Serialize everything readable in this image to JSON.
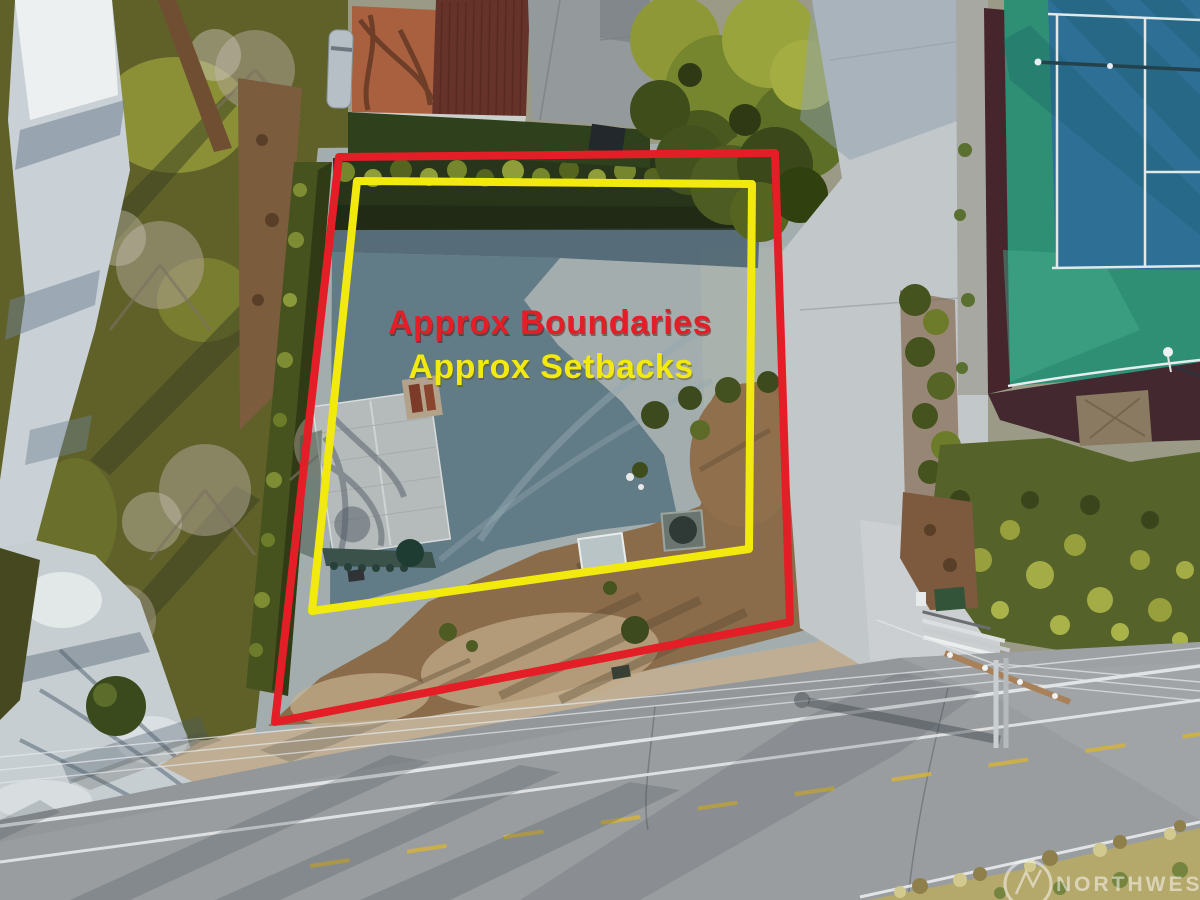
{
  "annotations": {
    "boundaries_label": "Approx Boundaries",
    "setbacks_label": "Approx Setbacks",
    "boundary_color": "#e31e26",
    "setback_color": "#f2e90e"
  },
  "watermark": {
    "brand": "NORTHWEST"
  }
}
